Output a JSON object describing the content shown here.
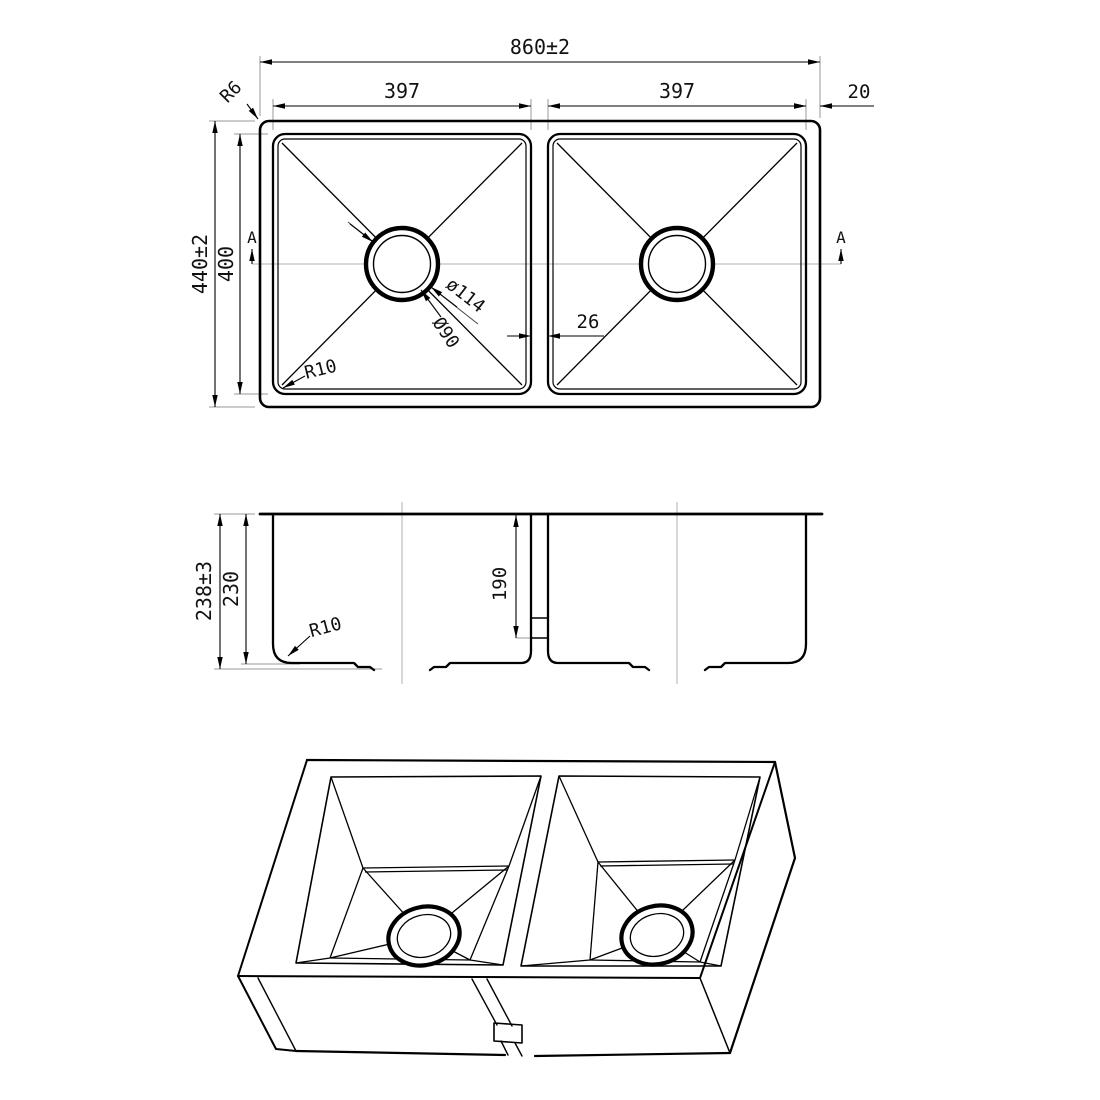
{
  "drawing": {
    "top_view": {
      "overall_width": "860±2",
      "bowl_width_left": "397",
      "bowl_width_right": "397",
      "right_edge_offset": "20",
      "overall_depth": "440±2",
      "bowl_depth": "400",
      "divider_width": "26",
      "drain_flange_dia": "ø114",
      "drain_hole_dia": "Ø90",
      "bowl_corner_radius": "R10",
      "rim_corner_radius": "R6",
      "section_marker_left": "A",
      "section_marker_right": "A"
    },
    "section_view": {
      "overall_height": "238±3",
      "bowl_inner_height": "230",
      "divider_height": "190",
      "bottom_corner_radius": "R10"
    }
  }
}
